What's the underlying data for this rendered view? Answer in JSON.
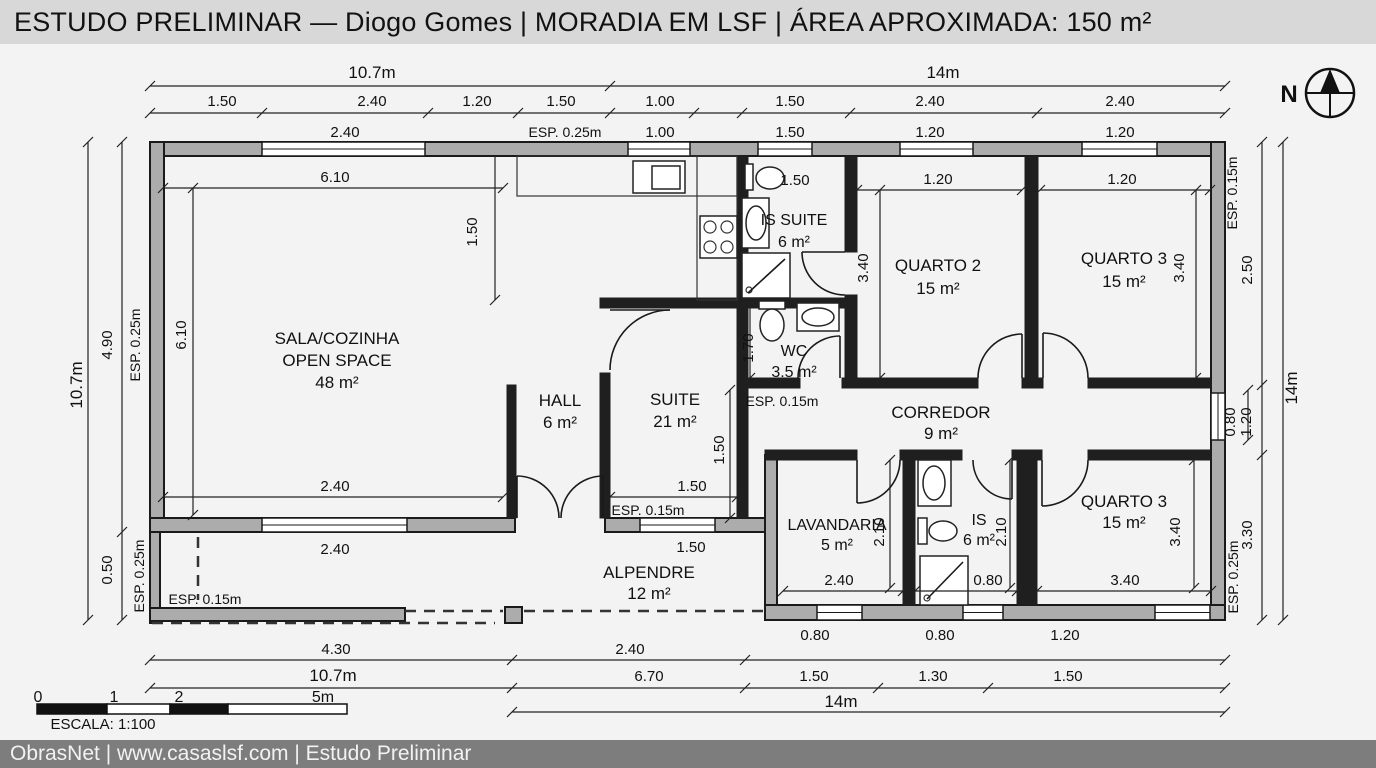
{
  "title": "ESTUDO PRELIMINAR — Diogo Gomes | MORADIA EM LSF | ÁREA APROXIMADA: 150 m²",
  "footer": "ObrasNet | www.casaslsf.com | Estudo Preliminar",
  "colors": {
    "title_bg": "#d8d8d8",
    "footer_bg": "#7d7d7d",
    "wall_fill": "#acacac",
    "line": "#1a1a1a",
    "canvas": "#f3f3f3"
  },
  "north": {
    "label": "N",
    "cx": 1330,
    "cy": 93,
    "r": 24
  },
  "scale_bar": {
    "caption": "ESCALA: 1:100",
    "rects": [
      [
        37,
        704,
        70,
        10,
        "#111111"
      ],
      [
        107,
        704,
        63,
        10,
        "#ffffff"
      ],
      [
        170,
        704,
        58,
        10,
        "#111111"
      ],
      [
        228,
        704,
        119,
        10,
        "#ffffff"
      ]
    ]
  },
  "plan": {
    "walls": [
      [
        150,
        142,
        1075,
        14
      ],
      [
        150,
        142,
        14,
        390
      ],
      [
        150,
        518,
        365,
        14
      ],
      [
        605,
        518,
        160,
        14
      ],
      [
        1211,
        142,
        14,
        478
      ],
      [
        150,
        532,
        10,
        91
      ],
      [
        150,
        608,
        255,
        13
      ],
      [
        765,
        605,
        460,
        15
      ],
      [
        765,
        455,
        12,
        150
      ],
      [
        505,
        607,
        17,
        16
      ]
    ],
    "iwalls": [
      [
        737,
        156,
        11,
        152
      ],
      [
        737,
        298,
        120,
        10
      ],
      [
        845,
        156,
        12,
        96
      ],
      [
        845,
        295,
        12,
        90
      ],
      [
        1025,
        156,
        13,
        222
      ],
      [
        857,
        378,
        121,
        10
      ],
      [
        1022,
        378,
        21,
        10
      ],
      [
        1088,
        378,
        123,
        10
      ],
      [
        600,
        298,
        148,
        10
      ],
      [
        600,
        373,
        10,
        145
      ],
      [
        507,
        385,
        9,
        133
      ],
      [
        737,
        308,
        11,
        210
      ],
      [
        765,
        450,
        92,
        10
      ],
      [
        900,
        450,
        62,
        10
      ],
      [
        1012,
        450,
        30,
        10
      ],
      [
        1088,
        450,
        123,
        10
      ],
      [
        903,
        455,
        12,
        150
      ],
      [
        1017,
        455,
        20,
        150
      ],
      [
        748,
        378,
        52,
        10
      ],
      [
        842,
        378,
        15,
        10
      ]
    ],
    "windows": [
      [
        262,
        142,
        163,
        14
      ],
      [
        628,
        142,
        62,
        14
      ],
      [
        758,
        142,
        54,
        14
      ],
      [
        900,
        142,
        73,
        14
      ],
      [
        1082,
        142,
        75,
        14
      ],
      [
        1211,
        393,
        14,
        47
      ],
      [
        817,
        605,
        45,
        15
      ],
      [
        963,
        605,
        40,
        15
      ],
      [
        1155,
        605,
        55,
        15
      ],
      [
        262,
        518,
        145,
        14
      ],
      [
        640,
        518,
        75,
        14
      ]
    ],
    "boxes": [
      [
        517,
        156,
        220,
        40,
        1
      ],
      [
        697,
        156,
        40,
        144,
        1
      ],
      [
        633,
        161,
        52,
        32,
        0
      ],
      [
        652,
        166,
        28,
        23,
        0
      ],
      [
        700,
        216,
        37,
        42,
        0
      ],
      [
        745,
        164,
        8,
        26,
        0
      ],
      [
        742,
        198,
        27,
        50,
        0
      ],
      [
        742,
        253,
        48,
        45,
        0
      ],
      [
        759,
        301,
        26,
        8,
        0
      ],
      [
        797,
        303,
        42,
        28,
        0
      ],
      [
        918,
        460,
        33,
        46,
        0
      ],
      [
        918,
        518,
        9,
        26,
        0
      ],
      [
        920,
        556,
        48,
        49,
        0
      ]
    ],
    "ellipses": [
      [
        770,
        178,
        14,
        11
      ],
      [
        756,
        223,
        10,
        17
      ],
      [
        772,
        325,
        12,
        16
      ],
      [
        818,
        317,
        16,
        9
      ],
      [
        934,
        483,
        11,
        17
      ],
      [
        943,
        531,
        14,
        10
      ]
    ],
    "circles": [
      [
        710,
        227,
        6
      ],
      [
        727,
        227,
        6
      ],
      [
        710,
        247,
        6
      ],
      [
        727,
        247,
        6
      ],
      [
        749,
        290,
        3
      ],
      [
        927,
        598,
        3
      ]
    ],
    "lines": [
      [
        748,
        293,
        785,
        259
      ],
      [
        927,
        599,
        963,
        562
      ],
      [
        517,
        476,
        517,
        518
      ],
      [
        603,
        476,
        603,
        518
      ],
      [
        802,
        252,
        845,
        252
      ],
      [
        840,
        336,
        840,
        378
      ],
      [
        1022,
        334,
        1022,
        378
      ],
      [
        1043,
        333,
        1043,
        378
      ],
      [
        857,
        460,
        857,
        503
      ],
      [
        1012,
        460,
        1012,
        499
      ],
      [
        1042,
        460,
        1042,
        506
      ],
      [
        610,
        310,
        670,
        310
      ]
    ],
    "dashes": [
      [
        198,
        537,
        198,
        600
      ],
      [
        405,
        611,
        503,
        611
      ],
      [
        524,
        611,
        763,
        611
      ],
      [
        152,
        623,
        495,
        623
      ]
    ],
    "arcs": [
      "M 559 518 A 42 42 0 0 0 517 476",
      "M 561 518 A 42 42 0 0 1 603 476",
      "M 802 252 A 43 43 0 0 0 845 295",
      "M 798 378 A 42 42 0 0 1 840 336",
      "M 978 378 A 44 44 0 0 1 1022 334",
      "M 1088 378 A 45 45 0 0 0 1043 333",
      "M 900 460 A 43 43 0 0 1 857 503",
      "M 973 460 A 39 39 0 0 0 1012 499",
      "M 1088 460 A 46 46 0 0 1 1042 506",
      "M 610 370 A 60 60 0 0 1 670 310"
    ],
    "dims": [
      {
        "o": "h",
        "p": 86,
        "a": 150,
        "b": 1225,
        "t": [
          150,
          610,
          1225
        ]
      },
      {
        "o": "h",
        "p": 113,
        "a": 150,
        "b": 1225,
        "t": [
          150,
          262,
          428,
          518,
          610,
          694,
          742,
          850,
          1037,
          1225
        ]
      },
      {
        "o": "h",
        "p": 188,
        "a": 163,
        "b": 503,
        "t": [
          163,
          503
        ]
      },
      {
        "o": "h",
        "p": 190,
        "a": 857,
        "b": 1022,
        "t": [
          857,
          1022
        ]
      },
      {
        "o": "h",
        "p": 190,
        "a": 1040,
        "b": 1210,
        "t": [
          1040,
          1210
        ]
      },
      {
        "o": "h",
        "p": 497,
        "a": 163,
        "b": 503,
        "t": [
          163,
          503
        ]
      },
      {
        "o": "h",
        "p": 497,
        "a": 610,
        "b": 737,
        "t": [
          610,
          737
        ]
      },
      {
        "o": "h",
        "p": 591,
        "a": 783,
        "b": 903,
        "t": [
          783,
          903
        ]
      },
      {
        "o": "h",
        "p": 591,
        "a": 915,
        "b": 1017,
        "t": [
          915,
          1017
        ]
      },
      {
        "o": "h",
        "p": 591,
        "a": 1037,
        "b": 1211,
        "t": [
          1037,
          1211
        ]
      },
      {
        "o": "h",
        "p": 660,
        "a": 150,
        "b": 1225,
        "t": [
          150,
          512,
          745,
          1225
        ]
      },
      {
        "o": "h",
        "p": 688,
        "a": 150,
        "b": 1225,
        "t": [
          150,
          512,
          745,
          878,
          988,
          1225
        ]
      },
      {
        "o": "h",
        "p": 712,
        "a": 512,
        "b": 1225,
        "t": [
          512,
          1225
        ]
      },
      {
        "o": "v",
        "p": 88,
        "a": 142,
        "b": 620,
        "t": [
          142,
          620
        ]
      },
      {
        "o": "v",
        "p": 122,
        "a": 142,
        "b": 620,
        "t": [
          142,
          532,
          620
        ]
      },
      {
        "o": "v",
        "p": 193,
        "a": 188,
        "b": 515,
        "t": [
          188,
          515
        ]
      },
      {
        "o": "v",
        "p": 495,
        "a": 156,
        "b": 300,
        "t": [
          300
        ]
      },
      {
        "o": "v",
        "p": 730,
        "a": 390,
        "b": 518,
        "t": [
          390,
          518
        ]
      },
      {
        "o": "v",
        "p": 750,
        "a": 305,
        "b": 378,
        "t": [
          305,
          378
        ]
      },
      {
        "o": "v",
        "p": 880,
        "a": 190,
        "b": 378,
        "t": [
          190,
          378
        ]
      },
      {
        "o": "v",
        "p": 1196,
        "a": 190,
        "b": 378,
        "t": [
          190,
          378
        ]
      },
      {
        "o": "v",
        "p": 890,
        "a": 460,
        "b": 588,
        "t": [
          460,
          588
        ]
      },
      {
        "o": "v",
        "p": 1010,
        "a": 460,
        "b": 588,
        "t": [
          460,
          588
        ]
      },
      {
        "o": "v",
        "p": 1194,
        "a": 460,
        "b": 588,
        "t": [
          460,
          588
        ]
      },
      {
        "o": "v",
        "p": 1248,
        "a": 390,
        "b": 440,
        "t": [
          390,
          440
        ]
      },
      {
        "o": "v",
        "p": 1262,
        "a": 142,
        "b": 620,
        "t": [
          142,
          385,
          455,
          620
        ]
      },
      {
        "o": "v",
        "p": 1283,
        "a": 142,
        "b": 620,
        "t": [
          142,
          620
        ]
      }
    ],
    "labels": [
      [
        "10.7m",
        372,
        78,
        0,
        17,
        ""
      ],
      [
        "14m",
        943,
        78,
        0,
        17,
        ""
      ],
      [
        "1.50",
        222,
        106,
        0,
        15,
        ""
      ],
      [
        "2.40",
        372,
        106,
        0,
        15,
        ""
      ],
      [
        "1.20",
        477,
        106,
        0,
        15,
        ""
      ],
      [
        "1.50",
        561,
        106,
        0,
        15,
        ""
      ],
      [
        "1.00",
        660,
        106,
        0,
        15,
        ""
      ],
      [
        "1.50",
        790,
        106,
        0,
        15,
        ""
      ],
      [
        "2.40",
        930,
        106,
        0,
        15,
        ""
      ],
      [
        "2.40",
        1120,
        106,
        0,
        15,
        ""
      ],
      [
        "2.40",
        345,
        137,
        0,
        15,
        ""
      ],
      [
        "ESP. 0.25m",
        565,
        137,
        0,
        14,
        ""
      ],
      [
        "1.00",
        660,
        137,
        0,
        15,
        ""
      ],
      [
        "1.50",
        790,
        137,
        0,
        15,
        ""
      ],
      [
        "1.20",
        930,
        137,
        0,
        15,
        ""
      ],
      [
        "1.20",
        1120,
        137,
        0,
        15,
        ""
      ],
      [
        "10.7m",
        82,
        385,
        1,
        17,
        ""
      ],
      [
        "4.90",
        112,
        345,
        1,
        15,
        ""
      ],
      [
        "0.50",
        112,
        570,
        1,
        15,
        ""
      ],
      [
        "ESP. 0.25m",
        140,
        345,
        1,
        14,
        ""
      ],
      [
        "ESP. 0.25m",
        144,
        576,
        1,
        14,
        ""
      ],
      [
        "6.10",
        335,
        182,
        0,
        15,
        ""
      ],
      [
        "6.10",
        186,
        335,
        1,
        15,
        ""
      ],
      [
        "1.50",
        477,
        232,
        1,
        15,
        ""
      ],
      [
        "2.40",
        335,
        491,
        0,
        15,
        ""
      ],
      [
        "2.40",
        335,
        554,
        0,
        15,
        ""
      ],
      [
        "1.50",
        795,
        185,
        0,
        15,
        ""
      ],
      [
        "1.20",
        938,
        184,
        0,
        15,
        ""
      ],
      [
        "3.40",
        868,
        268,
        1,
        15,
        ""
      ],
      [
        "1.20",
        1122,
        184,
        0,
        15,
        ""
      ],
      [
        "3.40",
        1184,
        268,
        1,
        15,
        ""
      ],
      [
        "ESP. 0.15m",
        1237,
        193,
        1,
        14,
        ""
      ],
      [
        "2.50",
        1252,
        270,
        1,
        15,
        ""
      ],
      [
        "0.80",
        1235,
        422,
        1,
        15,
        ""
      ],
      [
        "1.20",
        1251,
        422,
        1,
        15,
        ""
      ],
      [
        "3.30",
        1252,
        535,
        1,
        15,
        ""
      ],
      [
        "ESP. 0.25m",
        1238,
        577,
        1,
        14,
        ""
      ],
      [
        "14m",
        1297,
        388,
        1,
        17,
        ""
      ],
      [
        "1.70",
        753,
        348,
        1,
        15,
        ""
      ],
      [
        "ESP. 0.15m",
        782,
        406,
        0,
        14,
        ""
      ],
      [
        "1.50",
        692,
        491,
        0,
        15,
        ""
      ],
      [
        "ESP. 0.15m",
        648,
        515,
        0,
        14,
        ""
      ],
      [
        "1.50",
        724,
        450,
        1,
        15,
        ""
      ],
      [
        "2.40",
        839,
        585,
        0,
        15,
        ""
      ],
      [
        "0.80",
        988,
        585,
        0,
        15,
        ""
      ],
      [
        "3.40",
        1125,
        585,
        0,
        15,
        ""
      ],
      [
        "2.10",
        884,
        532,
        1,
        15,
        ""
      ],
      [
        "2.10",
        1006,
        532,
        1,
        15,
        ""
      ],
      [
        "3.40",
        1180,
        532,
        1,
        15,
        ""
      ],
      [
        "1.50",
        691,
        552,
        0,
        15,
        ""
      ],
      [
        "ESP. 0.15m",
        205,
        604,
        0,
        14,
        ""
      ],
      [
        "0.80",
        815,
        640,
        0,
        15,
        ""
      ],
      [
        "0.80",
        940,
        640,
        0,
        15,
        ""
      ],
      [
        "1.20",
        1065,
        640,
        0,
        15,
        ""
      ],
      [
        "4.30",
        336,
        654,
        0,
        15,
        ""
      ],
      [
        "2.40",
        630,
        654,
        0,
        15,
        ""
      ],
      [
        "10.7m",
        333,
        681,
        0,
        17,
        ""
      ],
      [
        "6.70",
        649,
        681,
        0,
        15,
        ""
      ],
      [
        "1.50",
        814,
        681,
        0,
        15,
        ""
      ],
      [
        "1.30",
        933,
        681,
        0,
        15,
        ""
      ],
      [
        "1.50",
        1068,
        681,
        0,
        15,
        ""
      ],
      [
        "14m",
        841,
        707,
        0,
        17,
        ""
      ],
      [
        "0",
        38,
        702,
        0,
        16,
        ""
      ],
      [
        "1",
        114,
        702,
        0,
        16,
        ""
      ],
      [
        "2",
        179,
        702,
        0,
        16,
        ""
      ],
      [
        "5m",
        323,
        702,
        0,
        16,
        ""
      ],
      [
        "ESCALA: 1:100",
        103,
        729,
        0,
        15,
        ""
      ],
      [
        "N",
        1289,
        102,
        0,
        24,
        "b"
      ]
    ],
    "rooms": [
      {
        "ls": [
          "SALA/COZINHA",
          "OPEN SPACE",
          "48 m²"
        ],
        "x": 337,
        "y": 344,
        "fs": 17,
        "lh": 22
      },
      {
        "ls": [
          "HALL",
          "6 m²"
        ],
        "x": 560,
        "y": 406,
        "fs": 17,
        "lh": 22
      },
      {
        "ls": [
          "SUITE",
          "21 m²"
        ],
        "x": 675,
        "y": 405,
        "fs": 17,
        "lh": 22
      },
      {
        "ls": [
          "IS SUITE",
          "6 m²"
        ],
        "x": 794,
        "y": 225,
        "fs": 16,
        "lh": 22
      },
      {
        "ls": [
          "QUARTO 2",
          "15 m²"
        ],
        "x": 938,
        "y": 271,
        "fs": 17,
        "lh": 23
      },
      {
        "ls": [
          "QUARTO 3",
          "15 m²"
        ],
        "x": 1124,
        "y": 264,
        "fs": 17,
        "lh": 23
      },
      {
        "ls": [
          "WC",
          "3.5 m²"
        ],
        "x": 794,
        "y": 356,
        "fs": 16,
        "lh": 21
      },
      {
        "ls": [
          "CORREDOR",
          "9 m²"
        ],
        "x": 941,
        "y": 418,
        "fs": 17,
        "lh": 21
      },
      {
        "ls": [
          "LAVANDARIA",
          "5 m²"
        ],
        "x": 837,
        "y": 530,
        "fs": 16,
        "lh": 20
      },
      {
        "ls": [
          "IS",
          "6 m²"
        ],
        "x": 979,
        "y": 525,
        "fs": 16,
        "lh": 20
      },
      {
        "ls": [
          "QUARTO 3",
          "15 m²"
        ],
        "x": 1124,
        "y": 507,
        "fs": 17,
        "lh": 21
      },
      {
        "ls": [
          "ALPENDRE",
          "12 m²"
        ],
        "x": 649,
        "y": 578,
        "fs": 17,
        "lh": 21
      }
    ]
  }
}
